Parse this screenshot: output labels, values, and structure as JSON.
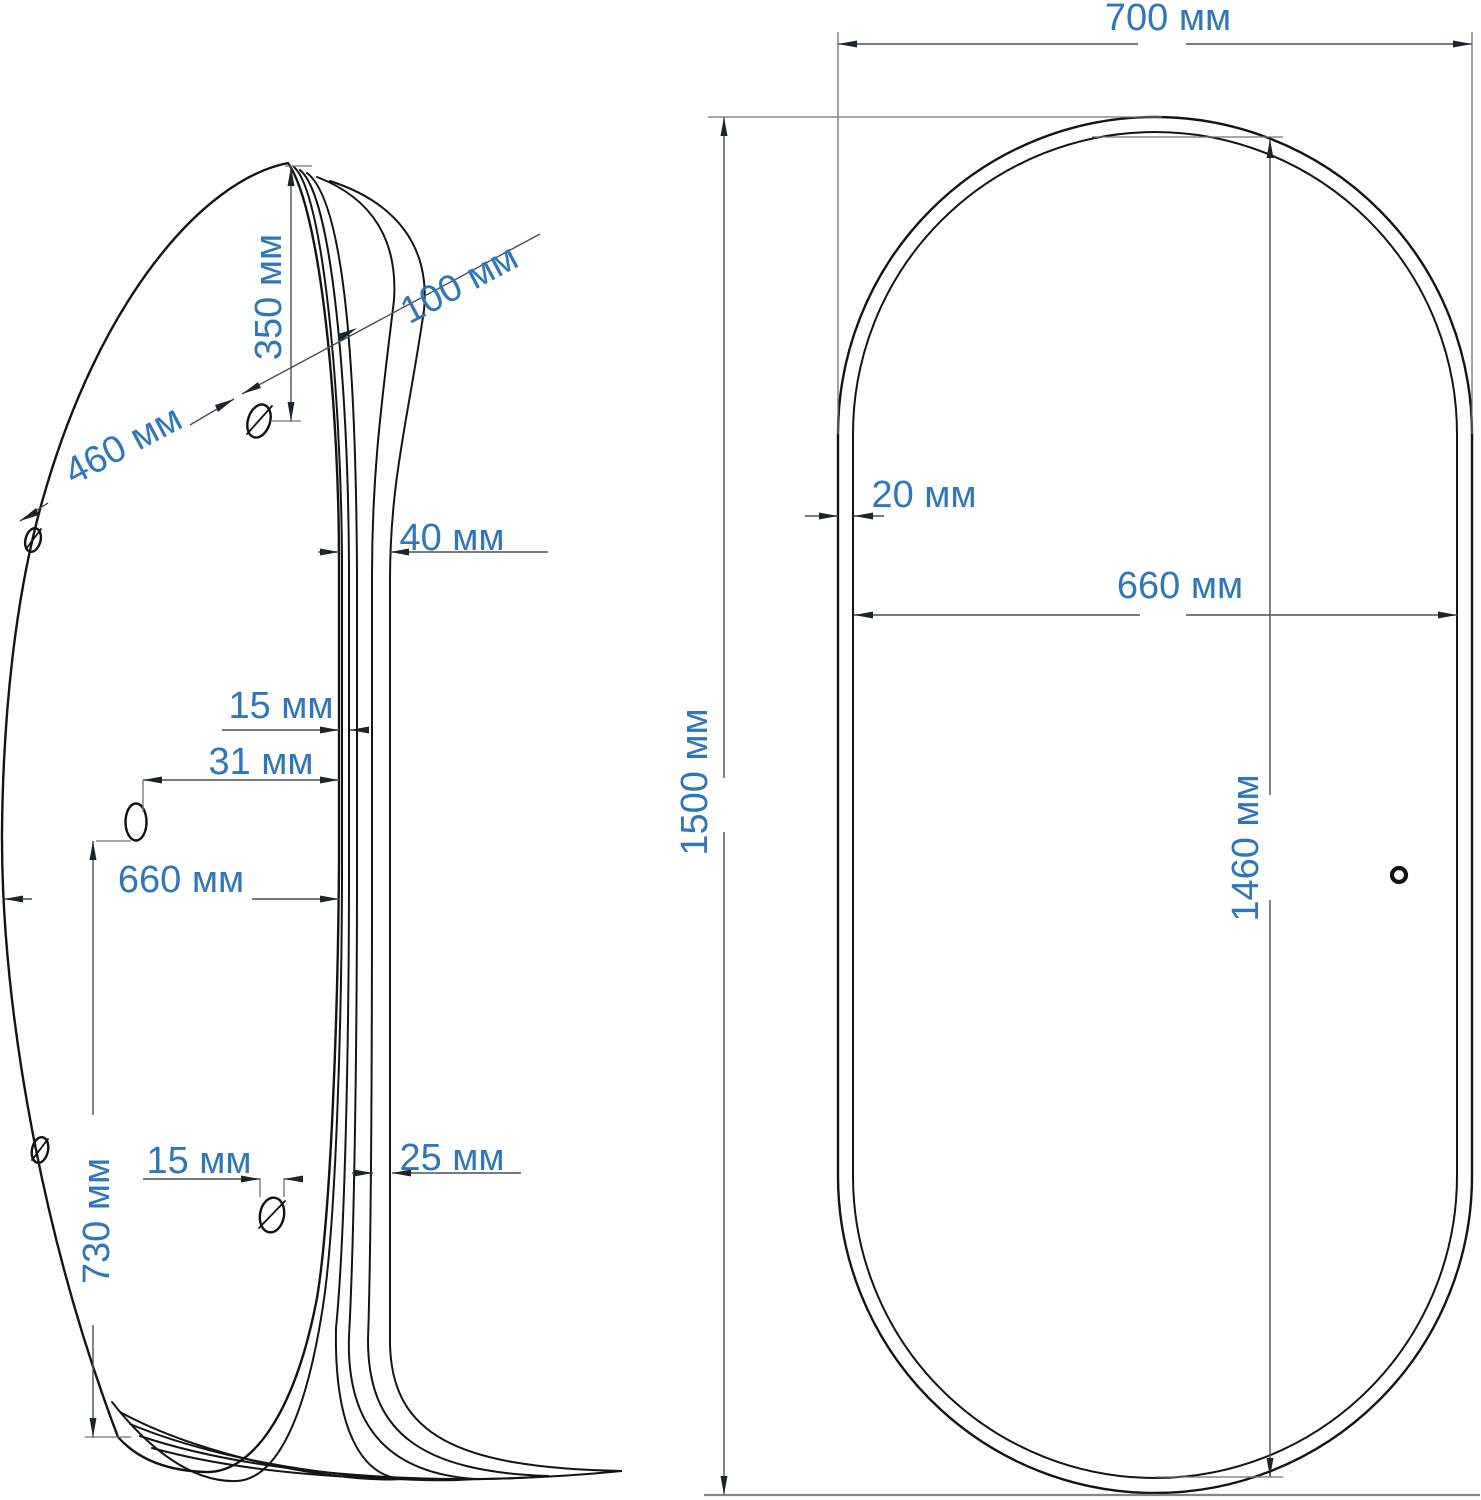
{
  "drawing": {
    "title": "oval-mirror-dimension-drawing",
    "colors": {
      "dimension_text": "#2f77ba",
      "outline": "#141414",
      "dimension_line": "#46505a",
      "background": "#ffffff"
    },
    "side_view": {
      "dim_350": "350 мм",
      "dim_100": "100 мм",
      "dim_460": "460 мм",
      "dim_40": "40 мм",
      "dim_15_top": "15 мм",
      "dim_31": "31 мм",
      "dim_660": "660 мм",
      "dim_730": "730 мм",
      "dim_15_bottom": "15 мм",
      "dim_25": "25 мм"
    },
    "front_view": {
      "dim_700": "700 мм",
      "dim_20": "20 мм",
      "dim_660": "660 мм",
      "dim_1500": "1500 мм",
      "dim_1460": "1460 мм"
    }
  }
}
